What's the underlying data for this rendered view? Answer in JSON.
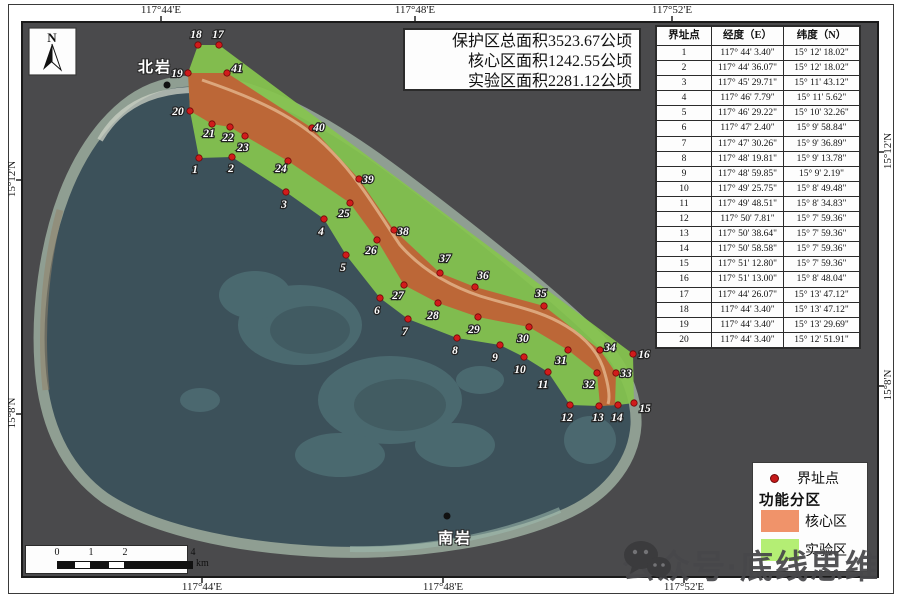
{
  "summary": {
    "lines": [
      "保护区总面积3523.67公顷",
      "核心区面积1242.55公顷",
      "实验区面积2281.12公顷"
    ]
  },
  "axis": {
    "top": [
      {
        "label": "117°44'E",
        "x": 161
      },
      {
        "label": "117°48'E",
        "x": 415
      },
      {
        "label": "117°52'E",
        "x": 672
      }
    ],
    "bottom": [
      {
        "label": "117°44'E",
        "x": 202
      },
      {
        "label": "117°48'E",
        "x": 443
      },
      {
        "label": "117°52'E",
        "x": 684
      }
    ],
    "left": [
      {
        "label": "15°12'N",
        "y": 180
      },
      {
        "label": "15°8'N",
        "y": 414
      }
    ],
    "right": [
      {
        "label": "15°12'N",
        "y": 152
      },
      {
        "label": "15°8'N",
        "y": 386
      }
    ]
  },
  "north_arrow": {
    "label": "N"
  },
  "scale_bar": {
    "ticks": [
      {
        "label": "0",
        "x": 31
      },
      {
        "label": "1",
        "x": 65
      },
      {
        "label": "2",
        "x": 99
      },
      {
        "label": "4",
        "x": 167
      }
    ],
    "unit": "km"
  },
  "places": [
    {
      "name": "北岩",
      "x": 150,
      "y": 56,
      "dot_x": 167,
      "dot_y": 85
    },
    {
      "name": "南岩",
      "x": 450,
      "y": 527,
      "dot_x": 447,
      "dot_y": 516
    }
  ],
  "table": {
    "headers": [
      "界址点",
      "经度（E）",
      "纬度（N）"
    ],
    "rows": [
      [
        "1",
        "117° 44' 3.40\"",
        "15° 12' 18.02\""
      ],
      [
        "2",
        "117° 44' 36.07\"",
        "15° 12' 18.02\""
      ],
      [
        "3",
        "117° 45' 29.71\"",
        "15° 11' 43.12\""
      ],
      [
        "4",
        "117° 46' 7.79\"",
        "15° 11' 5.62\""
      ],
      [
        "5",
        "117° 46' 29.22\"",
        "15° 10' 32.26\""
      ],
      [
        "6",
        "117° 47' 2.40\"",
        "15° 9' 58.84\""
      ],
      [
        "7",
        "117° 47' 30.26\"",
        "15° 9' 36.89\""
      ],
      [
        "8",
        "117° 48' 19.81\"",
        "15° 9' 13.78\""
      ],
      [
        "9",
        "117° 48' 59.85\"",
        "15° 9' 2.19\""
      ],
      [
        "10",
        "117° 49' 25.75\"",
        "15° 8' 49.48\""
      ],
      [
        "11",
        "117° 49' 48.51\"",
        "15° 8' 34.83\""
      ],
      [
        "12",
        "117° 50' 7.81\"",
        "15° 7' 59.36\""
      ],
      [
        "13",
        "117° 50' 38.64\"",
        "15° 7' 59.36\""
      ],
      [
        "14",
        "117° 50' 58.58\"",
        "15° 7' 59.36\""
      ],
      [
        "15",
        "117° 51' 12.80\"",
        "15° 7' 59.36\""
      ],
      [
        "16",
        "117° 51' 13.00\"",
        "15° 8' 48.04\""
      ],
      [
        "17",
        "117° 44' 26.07\"",
        "15° 13' 47.12\""
      ],
      [
        "18",
        "117° 44' 3.40\"",
        "15° 13' 47.12\""
      ],
      [
        "19",
        "117° 44' 3.40\"",
        "15° 13' 29.69\""
      ],
      [
        "20",
        "117° 44' 3.40\"",
        "15° 12' 51.91\""
      ]
    ]
  },
  "legend": {
    "point_label": "界址点",
    "group_title": "功能分区",
    "items": [
      {
        "label": "核心区",
        "color": "#f0936a"
      },
      {
        "label": "实验区",
        "color": "#b4ee74"
      }
    ]
  },
  "watermark": {
    "text": "公众号·底线思维"
  },
  "colors": {
    "sea": "#4a4a4c",
    "lagoon": "#3c515a",
    "rim": "#8f9e92",
    "core_zone": "#bf6236",
    "experiment_zone": "#87c64e",
    "boundary_dot": "#d11b1b",
    "crest_line": "#e2b288"
  },
  "points": [
    {
      "n": "1",
      "x": 199,
      "y": 158,
      "lx": 195,
      "ly": 173
    },
    {
      "n": "2",
      "x": 232,
      "y": 157,
      "lx": 231,
      "ly": 172
    },
    {
      "n": "3",
      "x": 286,
      "y": 192,
      "lx": 284,
      "ly": 208
    },
    {
      "n": "4",
      "x": 324,
      "y": 219,
      "lx": 321,
      "ly": 235
    },
    {
      "n": "5",
      "x": 346,
      "y": 255,
      "lx": 343,
      "ly": 271
    },
    {
      "n": "6",
      "x": 380,
      "y": 298,
      "lx": 377,
      "ly": 314
    },
    {
      "n": "7",
      "x": 408,
      "y": 319,
      "lx": 405,
      "ly": 335
    },
    {
      "n": "8",
      "x": 457,
      "y": 338,
      "lx": 455,
      "ly": 354
    },
    {
      "n": "9",
      "x": 500,
      "y": 345,
      "lx": 495,
      "ly": 361
    },
    {
      "n": "10",
      "x": 524,
      "y": 357,
      "lx": 520,
      "ly": 373
    },
    {
      "n": "11",
      "x": 548,
      "y": 372,
      "lx": 543,
      "ly": 388
    },
    {
      "n": "12",
      "x": 570,
      "y": 405,
      "lx": 567,
      "ly": 421
    },
    {
      "n": "13",
      "x": 599,
      "y": 406,
      "lx": 598,
      "ly": 421
    },
    {
      "n": "14",
      "x": 618,
      "y": 405,
      "lx": 617,
      "ly": 421
    },
    {
      "n": "15",
      "x": 634,
      "y": 403,
      "lx": 645,
      "ly": 412
    },
    {
      "n": "16",
      "x": 633,
      "y": 354,
      "lx": 644,
      "ly": 358
    },
    {
      "n": "17",
      "x": 219,
      "y": 45,
      "lx": 218,
      "ly": 38
    },
    {
      "n": "18",
      "x": 198,
      "y": 45,
      "lx": 196,
      "ly": 38
    },
    {
      "n": "19",
      "x": 188,
      "y": 73,
      "lx": 177,
      "ly": 77
    },
    {
      "n": "20",
      "x": 190,
      "y": 111,
      "lx": 178,
      "ly": 115
    },
    {
      "n": "21",
      "x": 212,
      "y": 124,
      "lx": 209,
      "ly": 137
    },
    {
      "n": "22",
      "x": 230,
      "y": 127,
      "lx": 228,
      "ly": 141
    },
    {
      "n": "23",
      "x": 245,
      "y": 136,
      "lx": 243,
      "ly": 151
    },
    {
      "n": "24",
      "x": 288,
      "y": 161,
      "lx": 281,
      "ly": 172
    },
    {
      "n": "25",
      "x": 350,
      "y": 203,
      "lx": 344,
      "ly": 217
    },
    {
      "n": "26",
      "x": 377,
      "y": 240,
      "lx": 371,
      "ly": 254
    },
    {
      "n": "27",
      "x": 404,
      "y": 285,
      "lx": 398,
      "ly": 299
    },
    {
      "n": "28",
      "x": 438,
      "y": 303,
      "lx": 433,
      "ly": 319
    },
    {
      "n": "29",
      "x": 478,
      "y": 317,
      "lx": 474,
      "ly": 333
    },
    {
      "n": "30",
      "x": 529,
      "y": 327,
      "lx": 523,
      "ly": 342
    },
    {
      "n": "31",
      "x": 568,
      "y": 350,
      "lx": 561,
      "ly": 364
    },
    {
      "n": "32",
      "x": 597,
      "y": 373,
      "lx": 589,
      "ly": 388
    },
    {
      "n": "33",
      "x": 616,
      "y": 373,
      "lx": 626,
      "ly": 377
    },
    {
      "n": "34",
      "x": 600,
      "y": 350,
      "lx": 610,
      "ly": 351
    },
    {
      "n": "35",
      "x": 544,
      "y": 306,
      "lx": 541,
      "ly": 297
    },
    {
      "n": "36",
      "x": 475,
      "y": 287,
      "lx": 483,
      "ly": 279
    },
    {
      "n": "37",
      "x": 440,
      "y": 273,
      "lx": 445,
      "ly": 262
    },
    {
      "n": "38",
      "x": 394,
      "y": 230,
      "lx": 403,
      "ly": 235
    },
    {
      "n": "39",
      "x": 359,
      "y": 179,
      "lx": 368,
      "ly": 183
    },
    {
      "n": "40",
      "x": 312,
      "y": 128,
      "lx": 319,
      "ly": 131
    },
    {
      "n": "41",
      "x": 227,
      "y": 73,
      "lx": 237,
      "ly": 72
    }
  ]
}
